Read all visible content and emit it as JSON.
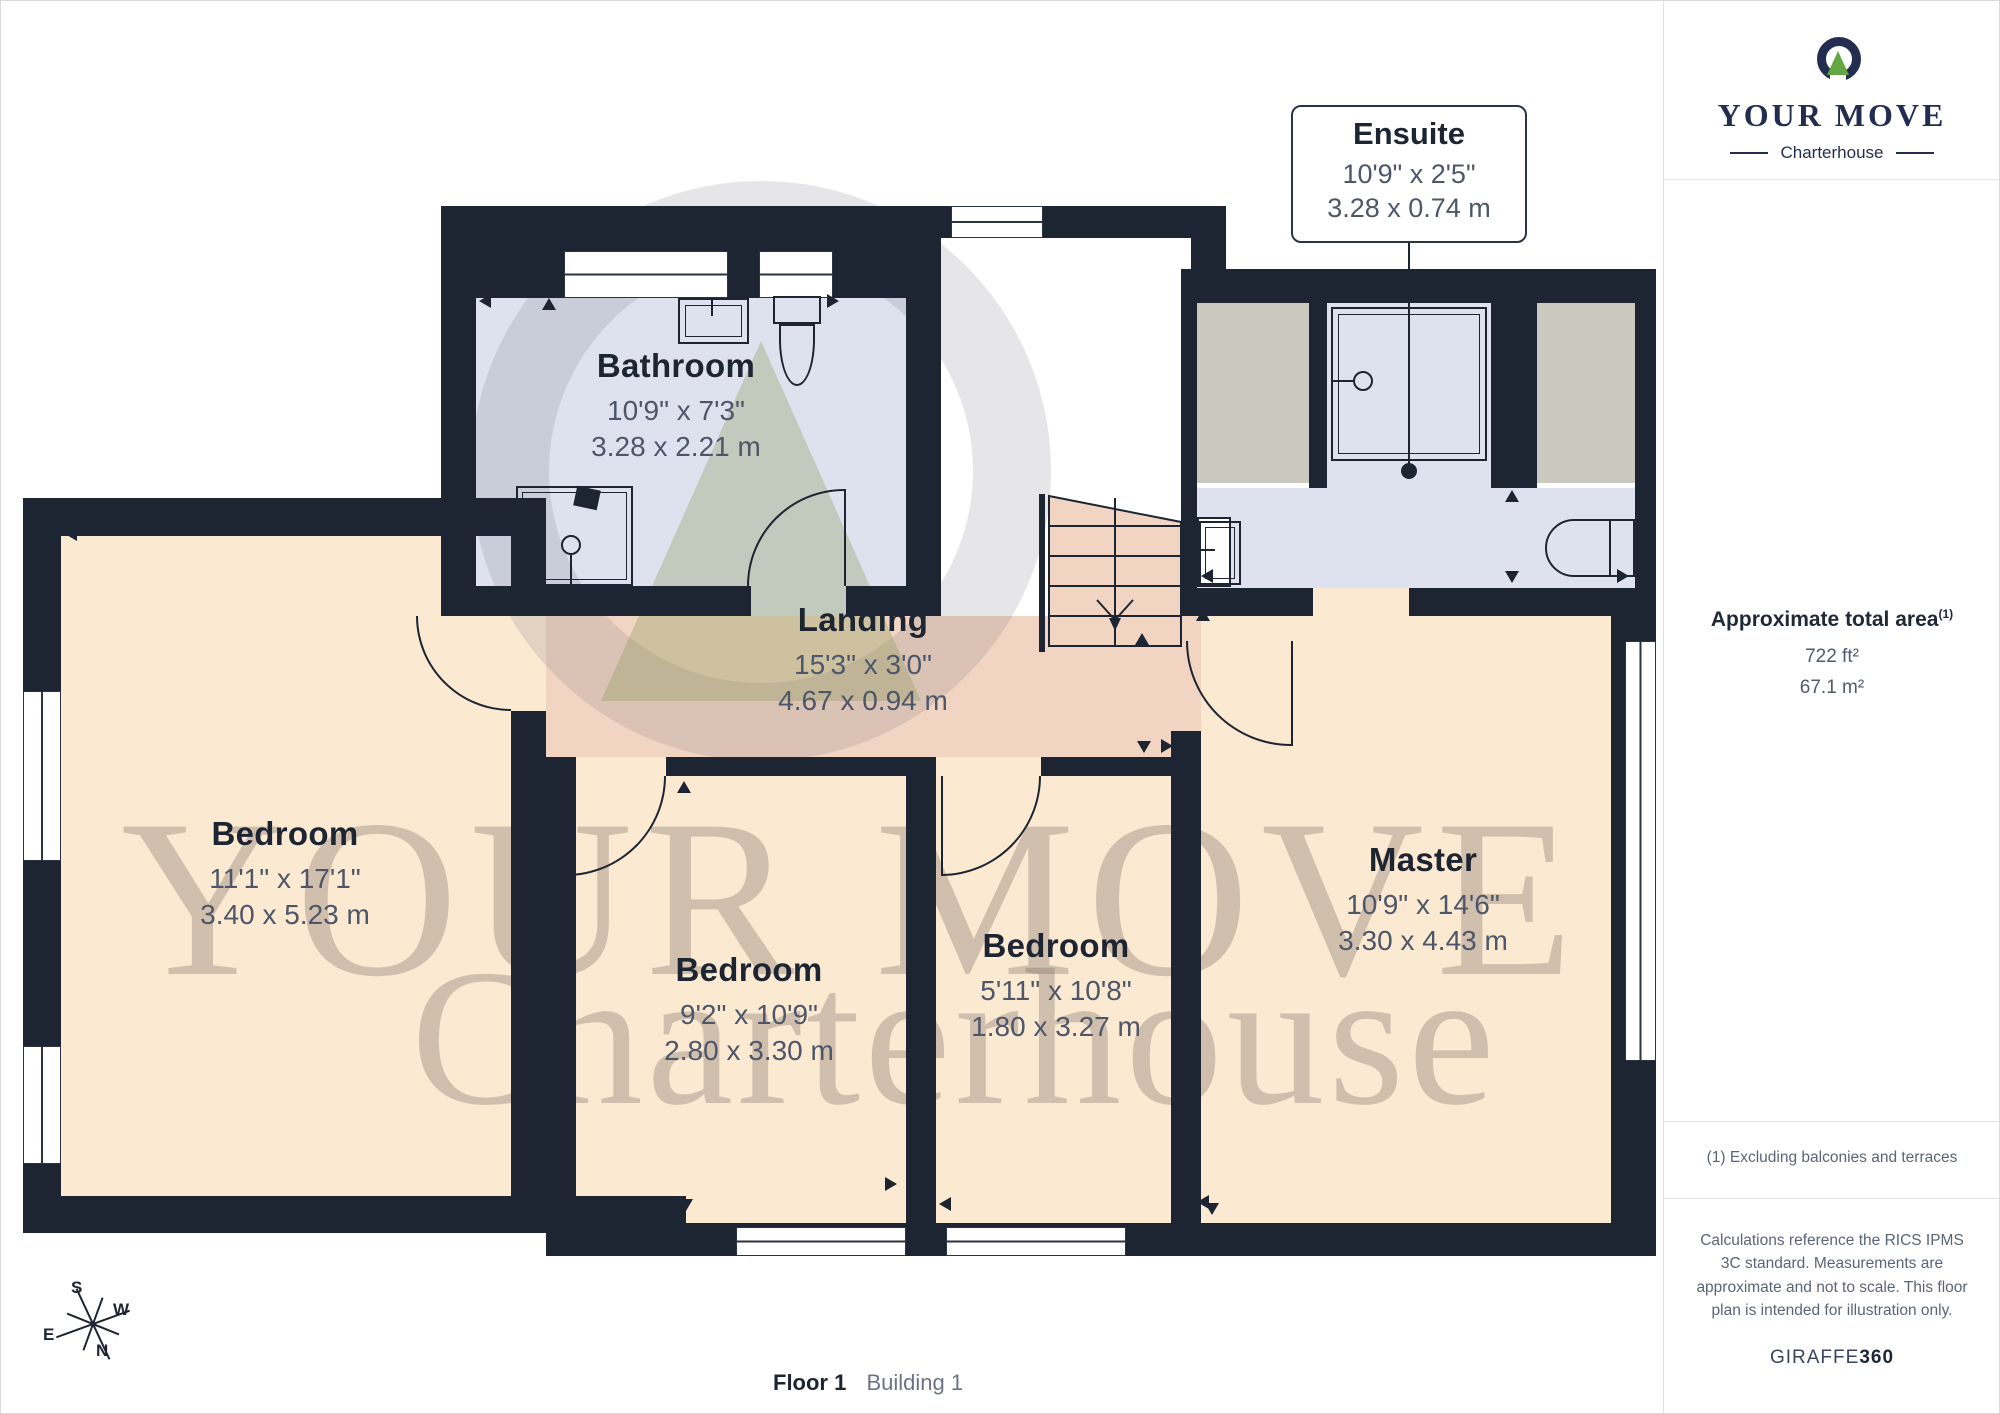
{
  "meta": {
    "floor_label": "Floor 1",
    "building_label": "Building 1"
  },
  "branding": {
    "name": "YOUR MOVE",
    "sub": "Charterhouse",
    "logo_mark": "ring-with-green-triangle-icon",
    "navy": "#232d4f",
    "green": "#62a744"
  },
  "watermark": {
    "line1": "YOUR MOVE",
    "line2": "Charterhouse"
  },
  "sidebar": {
    "area_title": "Approximate total area",
    "area_sup": "(1)",
    "area_ft": "722 ft²",
    "area_m": "67.1 m²",
    "footnote": "(1) Excluding balconies and terraces",
    "disclaimer": "Calculations reference the RICS IPMS 3C standard. Measurements are approximate and not to scale. This floor plan is intended for illustration only.",
    "brand_giraffe": "GIRAFFE",
    "brand_360": "360"
  },
  "rooms": {
    "bathroom": {
      "name": "Bathroom",
      "imperial": "10'9\" x 7'3\"",
      "metric": "3.28 x 2.21 m"
    },
    "landing": {
      "name": "Landing",
      "imperial": "15'3\" x 3'0\"",
      "metric": "4.67 x 0.94 m"
    },
    "bedroom_left": {
      "name": "Bedroom",
      "imperial": "11'1\" x 17'1\"",
      "metric": "3.40 x 5.23 m"
    },
    "bedroom_middle": {
      "name": "Bedroom",
      "imperial": "9'2\" x 10'9\"",
      "metric": "2.80 x 3.30 m"
    },
    "bedroom_small": {
      "name": "Bedroom",
      "imperial": "5'11\" x 10'8\"",
      "metric": "1.80 x 3.27 m"
    },
    "master": {
      "name": "Master",
      "imperial": "10'9\" x 14'6\"",
      "metric": "3.30 x 4.43 m"
    },
    "ensuite": {
      "name": "Ensuite",
      "imperial": "10'9\" x 2'5\"",
      "metric": "3.28 x 0.74 m"
    }
  },
  "compass": {
    "n": "N",
    "s": "S",
    "e": "E",
    "w": "W"
  },
  "colors": {
    "wall": "#1d2532",
    "bed": "#fbe9d2",
    "land": "#f1d5c2",
    "wet": "#dde2ee",
    "closet": "#cbc8c0",
    "navy": "#232d4f",
    "green": "#62a744",
    "dim": "#4d5769",
    "title": "#1d2532",
    "note": "#5a6477",
    "line": "#e3e3e3"
  }
}
